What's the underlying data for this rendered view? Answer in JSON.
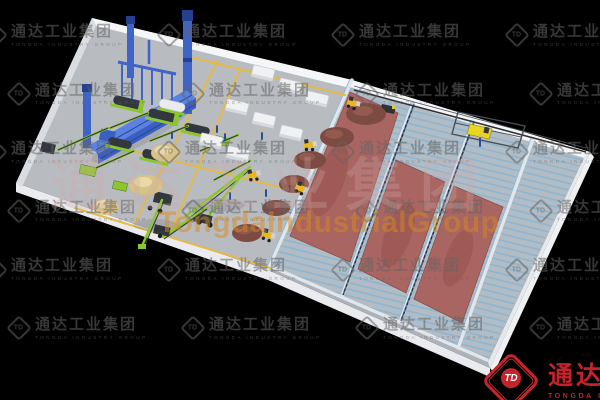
{
  "watermarks": {
    "tile": {
      "monogram": "TD",
      "cn": "通达工业集团",
      "en": "TONGDA INDUSTRY GROUP"
    },
    "center_cn": "通达工业集团",
    "center_latin": "TongdaIndustrialGroup"
  },
  "brand": {
    "monogram": "TD",
    "cn": "通达工业",
    "en": "TONGDA INDUS"
  },
  "palette": {
    "background": "#000000",
    "floor_main": "#b8bcc1",
    "floor_fermentation": "#acb2b9",
    "slab_edge_white": "#f5f6f7",
    "aeration_stripe_blue": "#8cb5d3",
    "compost_red": "#a96561",
    "pile_tan": "#d9c386",
    "pile_brown": "#7d4b42",
    "machine_green": "#8bc62e",
    "machine_dark": "#33383e",
    "plant_blue": "#3e64c8",
    "loader_yellow": "#e8b81d",
    "turner_yellow": "#e9d51f",
    "road_marking_yellow": "#e6b93f",
    "logo_red": "#c4232b",
    "watermark_orange": "#d88a1e"
  }
}
